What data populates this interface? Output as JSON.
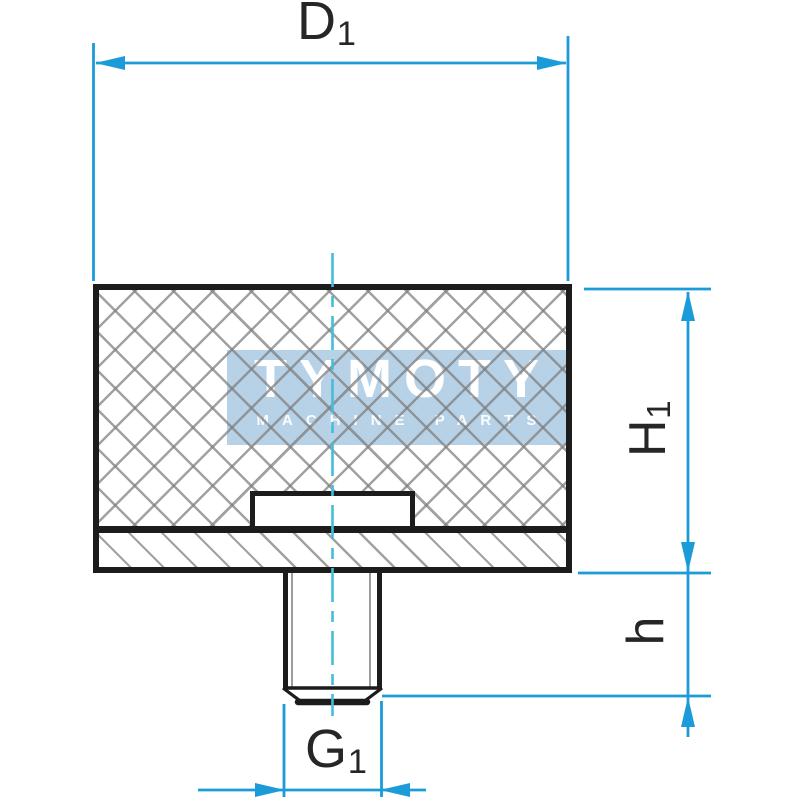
{
  "watermark": {
    "brand": "TYMOTY",
    "tagline": "MACHINE PARTS"
  },
  "dimensions": {
    "d1": {
      "label": "D",
      "subscript": "1"
    },
    "h1": {
      "label": "H",
      "subscript": "1"
    },
    "h": {
      "label": "h",
      "subscript": ""
    },
    "g1": {
      "label": "G",
      "subscript": "1"
    }
  },
  "colors": {
    "dimension_blue": "#1b9cd8",
    "centerline_cyan": "#45bdd8",
    "outline_black": "#1c1c1c",
    "hatch_gray": "#a8a8a8",
    "watermark_band_blue": "#b7d2e7",
    "watermark_text_white": "#ffffff"
  }
}
